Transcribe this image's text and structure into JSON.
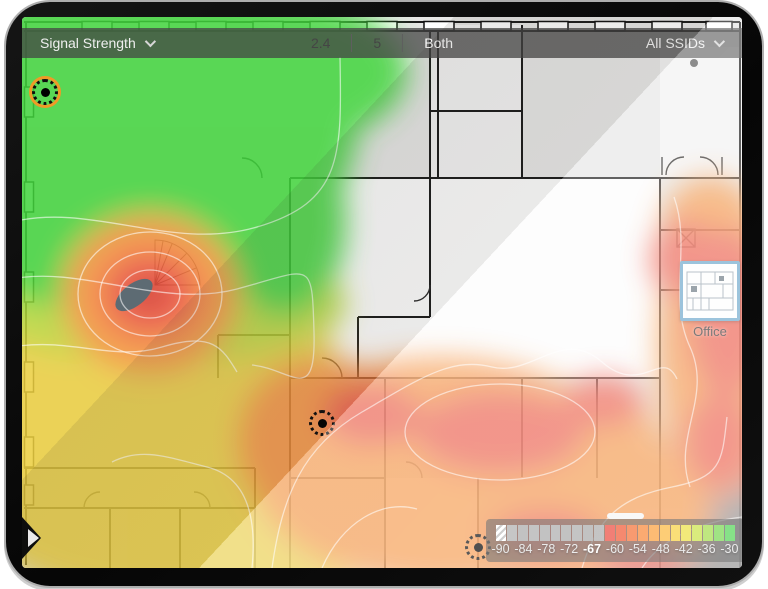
{
  "toolbar": {
    "view_selector": {
      "label": "Signal Strength"
    },
    "band_selector": {
      "options": [
        "2.4",
        "5",
        "Both"
      ],
      "selected": "Both"
    },
    "ssid_selector": {
      "label": "All SSIDs"
    }
  },
  "map": {
    "minimap_label": "Office",
    "access_point_count": 3,
    "selected_ap_ring_color": "#ef9a27"
  },
  "legend": {
    "type": "signal-strength-scale-dbm",
    "tick_labels": [
      "-90",
      "-84",
      "-78",
      "-72",
      "-67",
      "-60",
      "-54",
      "-48",
      "-42",
      "-36",
      "-30"
    ],
    "selected_threshold": "-67",
    "cells": [
      "hatch",
      "#ababab",
      "#a6a6a6",
      "#a9a9a9",
      "#a6a6a6",
      "#a9a9a9",
      "#a6a6a6",
      "#a9a9a9",
      "#a6a6a6",
      "#a9a9a9",
      "#ea4335",
      "#f0512b",
      "#f56a2c",
      "#f9822e",
      "#fb9b31",
      "#fcb534",
      "#f8cf37",
      "#ecde3a",
      "#c8e13e",
      "#a0dc43",
      "#72d648",
      "#4cd24e"
    ]
  },
  "heat_colors": {
    "excellent": "#43d43e",
    "good": "#bcd83b",
    "fair": "#eccf3f",
    "weak": "#f6923c",
    "poor": "#ee5340",
    "critical": "#d5301f",
    "no_coverage": "#848484"
  }
}
